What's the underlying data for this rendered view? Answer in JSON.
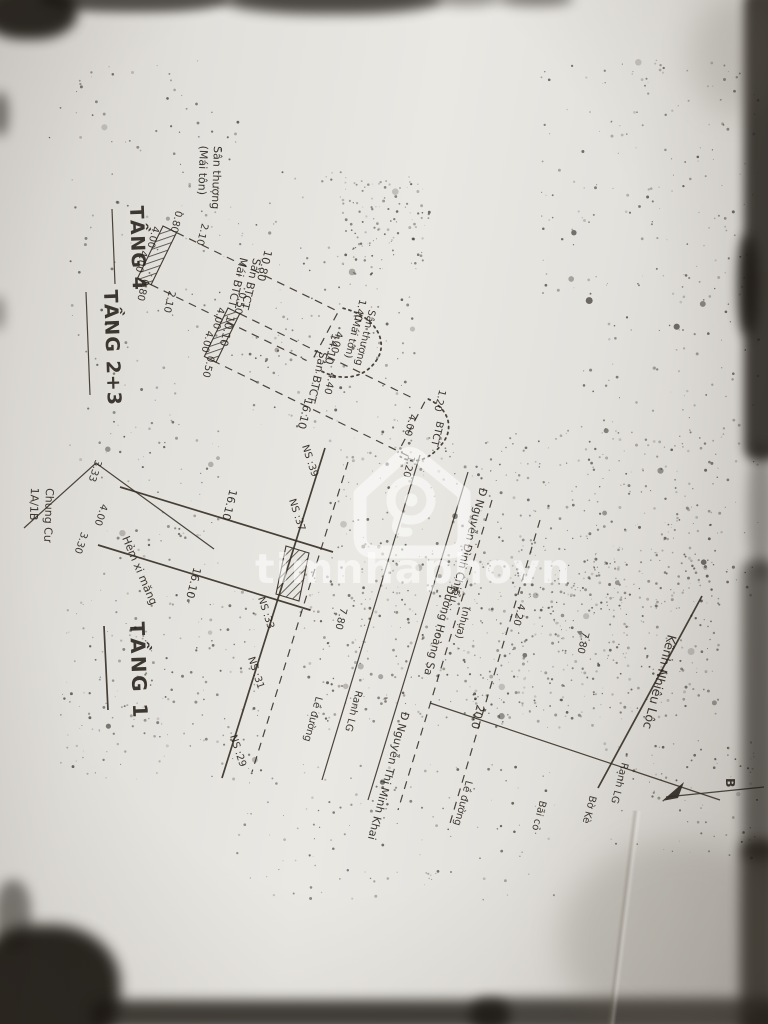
{
  "watermark": {
    "brand": "timnhaphovn"
  },
  "floor4": {
    "title": "TẦNG 4",
    "roof_note_1": "Sân thượng",
    "roof_note_2": "(Mái tôn)",
    "dim_top_a": "0.80",
    "dim_top_b": "2.10",
    "dim_left_a": "4.00",
    "dim_left_b": "4.00",
    "dim_span_top": "10.80",
    "slab_1": "Sàn BTCT",
    "slab_2": "Mái BTCT",
    "dim_span_bottom": "10.10",
    "dim_divider": "4.00",
    "terrace_1": "Sân thượng",
    "terrace_2": "(Mái tôn)",
    "dim_terrace_top": "1.40",
    "dim_terrace_bottom": "4.40",
    "dim_bottom_a": "0.80",
    "dim_bottom_b": "2.10"
  },
  "floor23": {
    "title": "TẦNG 2+3",
    "dim_top_a": "0.50",
    "dim_left_a": "4.00",
    "dim_left_b": "4.00",
    "dim_bottom_a": "0.50",
    "dim_span_top": "14.10",
    "slab": "Sàn BTCT",
    "dim_span_bottom": "16.10",
    "dim_balcony_top": "1.20",
    "balcony_label": "BTCT",
    "dim_balcony_depth": "4.00",
    "dim_balcony_bottom": "1.20"
  },
  "floor1": {
    "title": "TẦNG 1",
    "chungcu_1": "Chung Cư",
    "chungcu_2": "1A/1B",
    "dim_front_a": "3.33",
    "dim_front_b": "4.00",
    "dim_front_c": "3.30",
    "alley": "Hẻm xi măng",
    "dim_side_1": "16.10",
    "dim_side_2": "16.10",
    "neighbors": [
      "NS :39",
      "NS :37",
      "NS :33",
      "NS :31",
      "NS :29"
    ]
  },
  "site": {
    "sidewalk_1": "Lề đường",
    "sidewalk_2": "Lề đường",
    "ranh_lg_1": "Ranh LG",
    "ranh_lg_2": "Ranh LG",
    "road_1": "Đ Nguyễn Đình Chiểu",
    "road_surface": "(nhựa)",
    "road_2": "Đường Hoàng Sa",
    "road_3": "Đ Nguyễn Thị Minh Khai",
    "dim_1": "7.80",
    "dim_2": "4.20",
    "dim_3": "7.80",
    "dim_road_width": "20.0",
    "grass": "Bãi cỏ",
    "embankment": "Bờ Kè",
    "canal": "Kênh Nhiêu Lộc",
    "north": "B"
  }
}
